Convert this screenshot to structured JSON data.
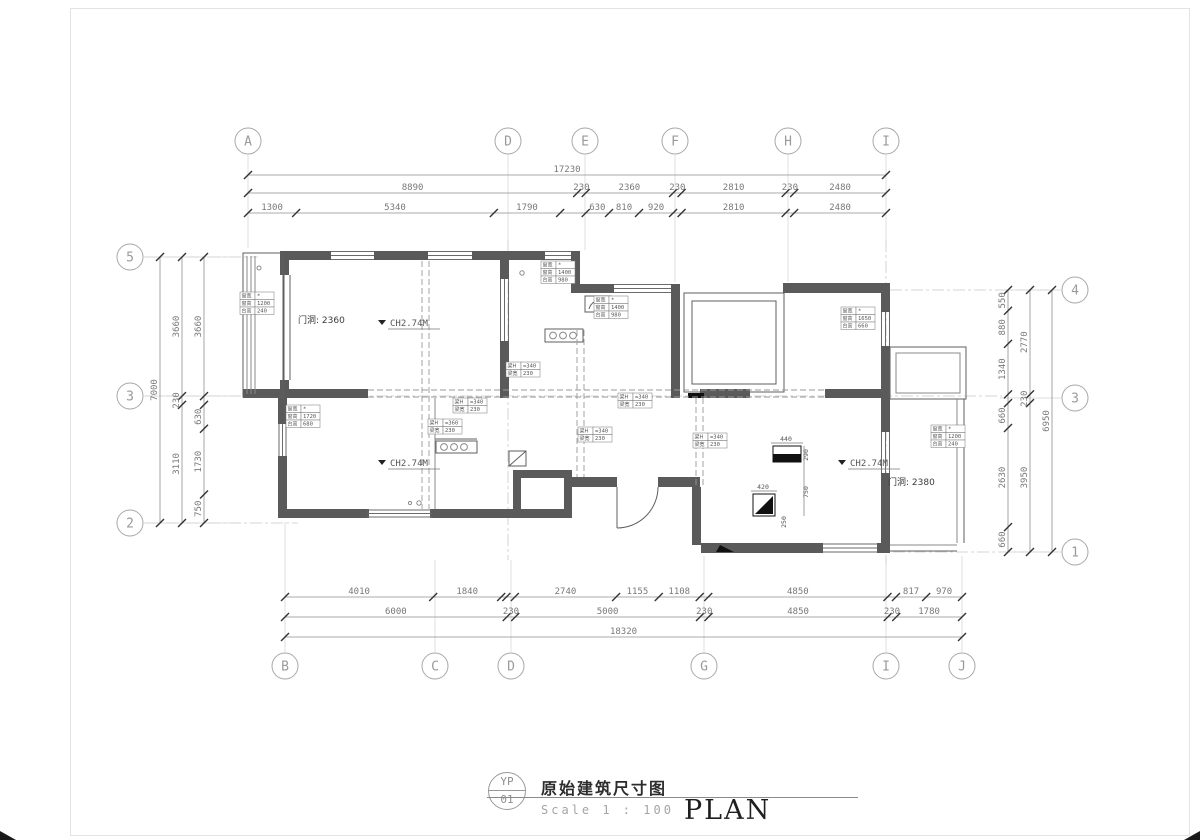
{
  "title_block": {
    "circle_top": "YP",
    "circle_bottom": "01",
    "title": "原始建筑尺寸图",
    "scale_label": "Scale 1 :  100",
    "plan_label": "PLAN"
  },
  "grid_bubbles": {
    "top": [
      {
        "label": "A",
        "x": 248,
        "y": 141
      },
      {
        "label": "D",
        "x": 508,
        "y": 141
      },
      {
        "label": "E",
        "x": 585,
        "y": 141
      },
      {
        "label": "F",
        "x": 675,
        "y": 141
      },
      {
        "label": "H",
        "x": 788,
        "y": 141
      },
      {
        "label": "I",
        "x": 886,
        "y": 141
      }
    ],
    "bottom": [
      {
        "label": "B",
        "x": 285,
        "y": 666
      },
      {
        "label": "C",
        "x": 435,
        "y": 666
      },
      {
        "label": "D",
        "x": 511,
        "y": 666
      },
      {
        "label": "G",
        "x": 704,
        "y": 666
      },
      {
        "label": "I",
        "x": 886,
        "y": 666
      },
      {
        "label": "J",
        "x": 962,
        "y": 666
      }
    ],
    "left": [
      {
        "label": "5",
        "x": 130,
        "y": 257
      },
      {
        "label": "3",
        "x": 130,
        "y": 396
      },
      {
        "label": "2",
        "x": 130,
        "y": 523
      }
    ],
    "right": [
      {
        "label": "4",
        "x": 1075,
        "y": 290
      },
      {
        "label": "3",
        "x": 1075,
        "y": 398
      },
      {
        "label": "1",
        "x": 1075,
        "y": 552
      }
    ]
  },
  "dimensions": {
    "rows": [
      {
        "o": "h",
        "y": 175,
        "a": 248,
        "b": 886,
        "segments": [
          {
            "v": 17230,
            "t": "17230"
          }
        ]
      },
      {
        "o": "h",
        "y": 193,
        "a": 248,
        "b": 886,
        "segments": [
          {
            "v": 8890,
            "t": "8890"
          },
          {
            "v": 230,
            "t": "230"
          },
          {
            "v": 2360,
            "t": "2360"
          },
          {
            "v": 230,
            "t": "230"
          },
          {
            "v": 2810,
            "t": "2810"
          },
          {
            "v": 230,
            "t": "230"
          },
          {
            "v": 2480,
            "t": "2480"
          }
        ]
      },
      {
        "o": "h",
        "y": 213,
        "a": 248,
        "b": 886,
        "segments": [
          {
            "v": 1300,
            "t": "1300"
          },
          {
            "v": 5340,
            "t": "5340"
          },
          {
            "v": 1790,
            "t": "1790"
          },
          {
            "v": 690,
            "t": ""
          },
          {
            "v": 630,
            "t": "630"
          },
          {
            "v": 810,
            "t": "810"
          },
          {
            "v": 920,
            "t": "920"
          },
          {
            "v": 230,
            "t": ""
          },
          {
            "v": 2810,
            "t": "2810"
          },
          {
            "v": 230,
            "t": ""
          },
          {
            "v": 2480,
            "t": "2480"
          }
        ]
      },
      {
        "o": "h",
        "y": 597,
        "a": 285,
        "b": 962,
        "segments": [
          {
            "v": 4010,
            "t": "4010"
          },
          {
            "v": 1840,
            "t": "1840"
          },
          {
            "v": 140,
            "t": ""
          },
          {
            "v": 230,
            "t": ""
          },
          {
            "v": 2740,
            "t": "2740"
          },
          {
            "v": 1155,
            "t": "1155"
          },
          {
            "v": 1108,
            "t": "1108"
          },
          {
            "v": 230,
            "t": ""
          },
          {
            "v": 4850,
            "t": "4850"
          },
          {
            "v": 230,
            "t": ""
          },
          {
            "v": 817,
            "t": "817"
          },
          {
            "v": 970,
            "t": "970"
          }
        ]
      },
      {
        "o": "h",
        "y": 617,
        "a": 285,
        "b": 962,
        "segments": [
          {
            "v": 6000,
            "t": "6000"
          },
          {
            "v": 230,
            "t": "230"
          },
          {
            "v": 5000,
            "t": "5000"
          },
          {
            "v": 230,
            "t": "230"
          },
          {
            "v": 4850,
            "t": "4850"
          },
          {
            "v": 230,
            "t": "230"
          },
          {
            "v": 1780,
            "t": "1780"
          }
        ]
      },
      {
        "o": "h",
        "y": 637,
        "a": 285,
        "b": 962,
        "segments": [
          {
            "v": 18320,
            "t": "18320"
          }
        ]
      },
      {
        "o": "v",
        "x": 160,
        "a": 257,
        "b": 523,
        "segments": [
          {
            "v": 7000,
            "t": "7000"
          }
        ]
      },
      {
        "o": "v",
        "x": 182,
        "a": 257,
        "b": 523,
        "segments": [
          {
            "v": 3660,
            "t": "3660"
          },
          {
            "v": 230,
            "t": "230"
          },
          {
            "v": 3110,
            "t": "3110"
          }
        ]
      },
      {
        "o": "v",
        "x": 204,
        "a": 257,
        "b": 523,
        "segments": [
          {
            "v": 3660,
            "t": "3660"
          },
          {
            "v": 230,
            "t": ""
          },
          {
            "v": 630,
            "t": "630"
          },
          {
            "v": 1730,
            "t": "1730"
          },
          {
            "v": 750,
            "t": "750"
          }
        ]
      },
      {
        "o": "v",
        "x": 1008,
        "a": 290,
        "b": 552,
        "segments": [
          {
            "v": 550,
            "t": "550"
          },
          {
            "v": 880,
            "t": "880"
          },
          {
            "v": 1340,
            "t": "1340"
          },
          {
            "v": 230,
            "t": ""
          },
          {
            "v": 660,
            "t": "660"
          },
          {
            "v": 2630,
            "t": "2630"
          },
          {
            "v": 660,
            "t": "660"
          }
        ]
      },
      {
        "o": "v",
        "x": 1030,
        "a": 290,
        "b": 552,
        "segments": [
          {
            "v": 2770,
            "t": "2770"
          },
          {
            "v": 230,
            "t": "230"
          },
          {
            "v": 3950,
            "t": "3950"
          }
        ]
      },
      {
        "o": "v",
        "x": 1052,
        "a": 290,
        "b": 552,
        "segments": [
          {
            "v": 6950,
            "t": "6950"
          }
        ]
      }
    ]
  },
  "plan_annotations": {
    "ch_labels": [
      {
        "text": "CH2.74M",
        "x": 378,
        "y": 320
      },
      {
        "text": "CH2.74M",
        "x": 378,
        "y": 460
      },
      {
        "text": "CH2.74M",
        "x": 838,
        "y": 460
      }
    ],
    "door_labels": [
      {
        "text": "门洞: 2360",
        "x": 298,
        "y": 323
      },
      {
        "text": "门洞: 2380",
        "x": 888,
        "y": 485
      }
    ],
    "window_tables": [
      {
        "x": 240,
        "y": 292,
        "rows": [
          [
            "窗宽",
            "*"
          ],
          [
            "窗高",
            "1200"
          ],
          [
            "台高",
            "240"
          ]
        ]
      },
      {
        "x": 541,
        "y": 261,
        "rows": [
          [
            "窗宽",
            "*"
          ],
          [
            "窗高",
            "1400"
          ],
          [
            "台高",
            "980"
          ]
        ]
      },
      {
        "x": 594,
        "y": 296,
        "rows": [
          [
            "窗宽",
            "*"
          ],
          [
            "窗高",
            "1400"
          ],
          [
            "台高",
            "980"
          ]
        ]
      },
      {
        "x": 841,
        "y": 307,
        "rows": [
          [
            "窗宽",
            "*"
          ],
          [
            "窗高",
            "1650"
          ],
          [
            "台高",
            "660"
          ]
        ]
      },
      {
        "x": 286,
        "y": 405,
        "rows": [
          [
            "窗宽",
            "*"
          ],
          [
            "窗高",
            "1720"
          ],
          [
            "台高",
            "680"
          ]
        ]
      },
      {
        "x": 931,
        "y": 425,
        "rows": [
          [
            "窗宽",
            "*"
          ],
          [
            "窗高",
            "1200"
          ],
          [
            "台高",
            "240"
          ]
        ]
      }
    ],
    "beam_tables": [
      {
        "x": 506,
        "y": 362,
        "rows": [
          [
            "梁H",
            "=340"
          ],
          [
            "梁宽",
            "230"
          ]
        ]
      },
      {
        "x": 453,
        "y": 398,
        "rows": [
          [
            "梁H",
            "=340"
          ],
          [
            "梁宽",
            "230"
          ]
        ]
      },
      {
        "x": 428,
        "y": 419,
        "rows": [
          [
            "梁H",
            "=360"
          ],
          [
            "梁宽",
            "230"
          ]
        ]
      },
      {
        "x": 618,
        "y": 393,
        "rows": [
          [
            "梁H",
            "=340"
          ],
          [
            "梁宽",
            "230"
          ]
        ]
      },
      {
        "x": 578,
        "y": 427,
        "rows": [
          [
            "梁H",
            "=340"
          ],
          [
            "梁宽",
            "230"
          ]
        ]
      },
      {
        "x": 693,
        "y": 433,
        "rows": [
          [
            "梁H",
            "=340"
          ],
          [
            "梁宽",
            "230"
          ]
        ]
      }
    ],
    "duct_dims": [
      {
        "text": "440",
        "x": 786,
        "y": 441,
        "rot": 0
      },
      {
        "text": "290",
        "x": 808,
        "y": 455,
        "rot": -90
      },
      {
        "text": "420",
        "x": 763,
        "y": 489,
        "rot": 0
      },
      {
        "text": "750",
        "x": 808,
        "y": 492,
        "rot": -90
      },
      {
        "text": "250",
        "x": 786,
        "y": 522,
        "rot": -90
      }
    ]
  }
}
